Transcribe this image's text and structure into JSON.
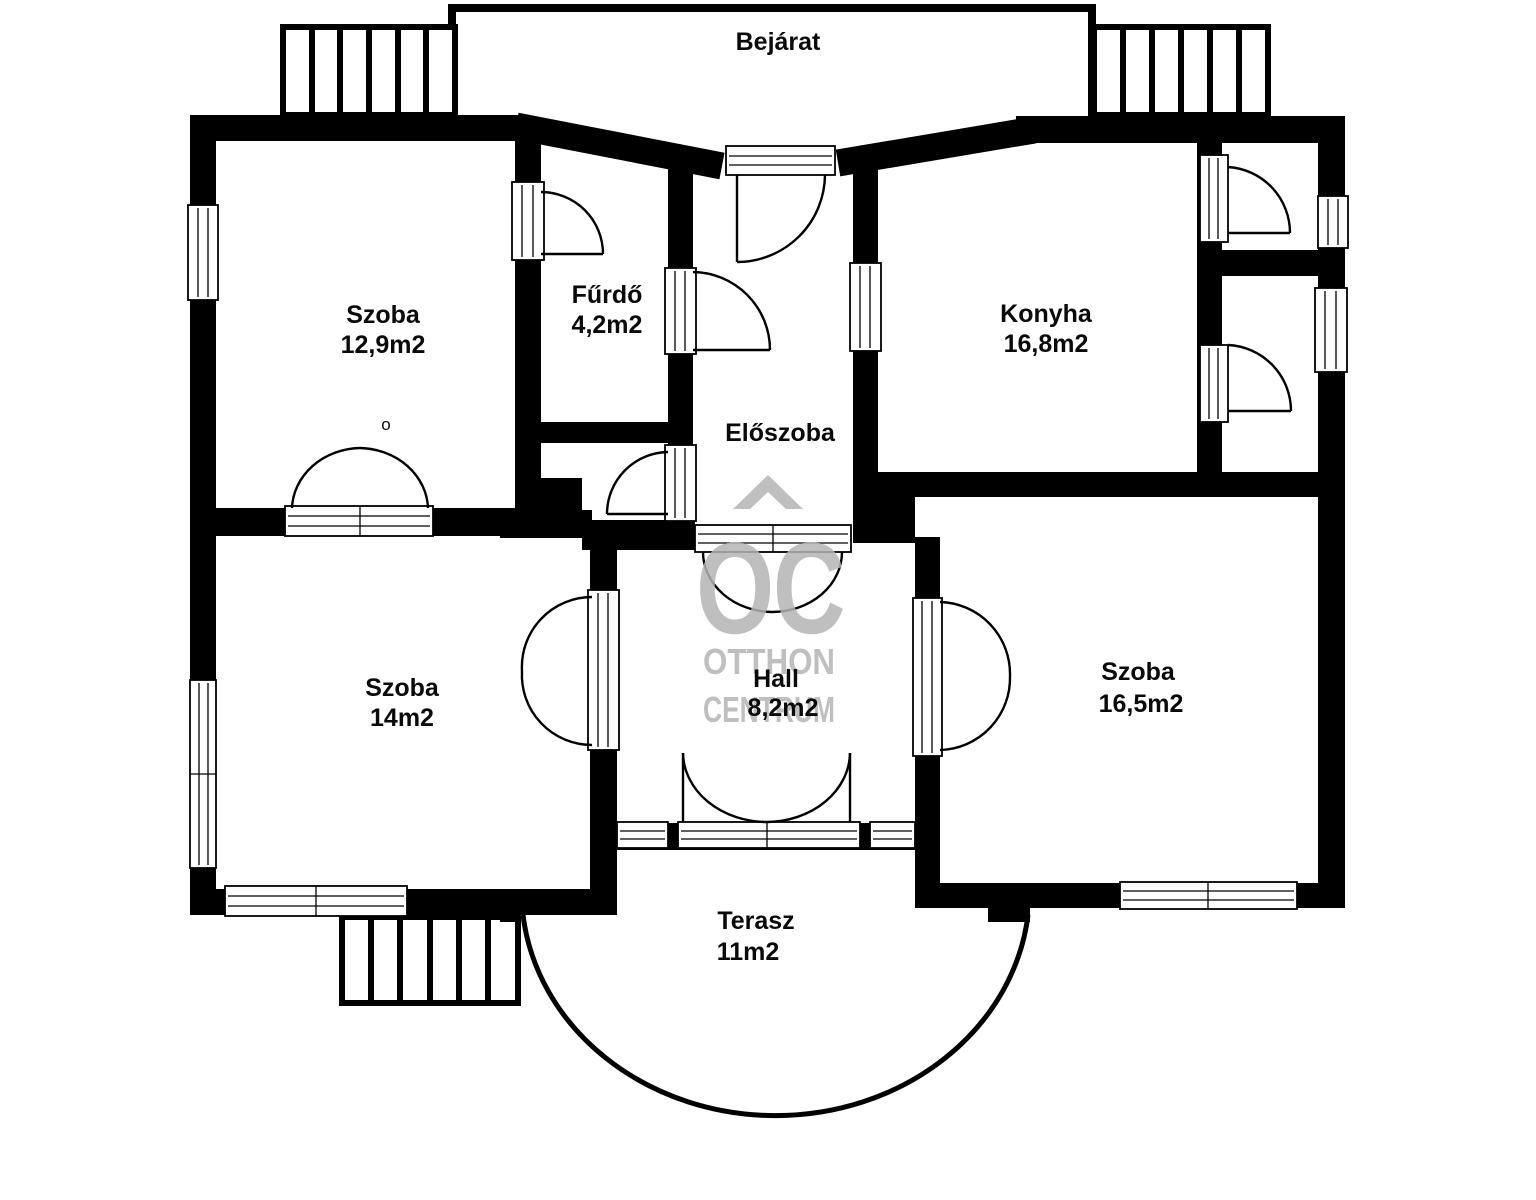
{
  "plan": {
    "entrance_label": "Bejárat",
    "rooms": [
      {
        "key": "szoba-top-left",
        "name": "Szoba",
        "area": "12,9m2"
      },
      {
        "key": "furdo",
        "name": "Fűrdő",
        "area": "4,2m2"
      },
      {
        "key": "eloszoba",
        "name": "Előszoba",
        "area": ""
      },
      {
        "key": "konyha",
        "name": "Konyha",
        "area": "16,8m2"
      },
      {
        "key": "szoba-middle-left",
        "name": "Szoba",
        "area": "14m2"
      },
      {
        "key": "hall",
        "name": "Hall",
        "area": "8,2m2"
      },
      {
        "key": "szoba-right",
        "name": "Szoba",
        "area": "16,5m2"
      },
      {
        "key": "terasz",
        "name": "Terasz",
        "area": "11m2"
      }
    ],
    "annotations": {
      "door_mark": "o"
    },
    "watermark": {
      "monogram": "OC",
      "name_line1": "OTTHON",
      "name_line2": "CENTRUM"
    },
    "colors": {
      "wall": "#000000",
      "background": "#ffffff",
      "watermark": "#b4b4b4"
    }
  }
}
